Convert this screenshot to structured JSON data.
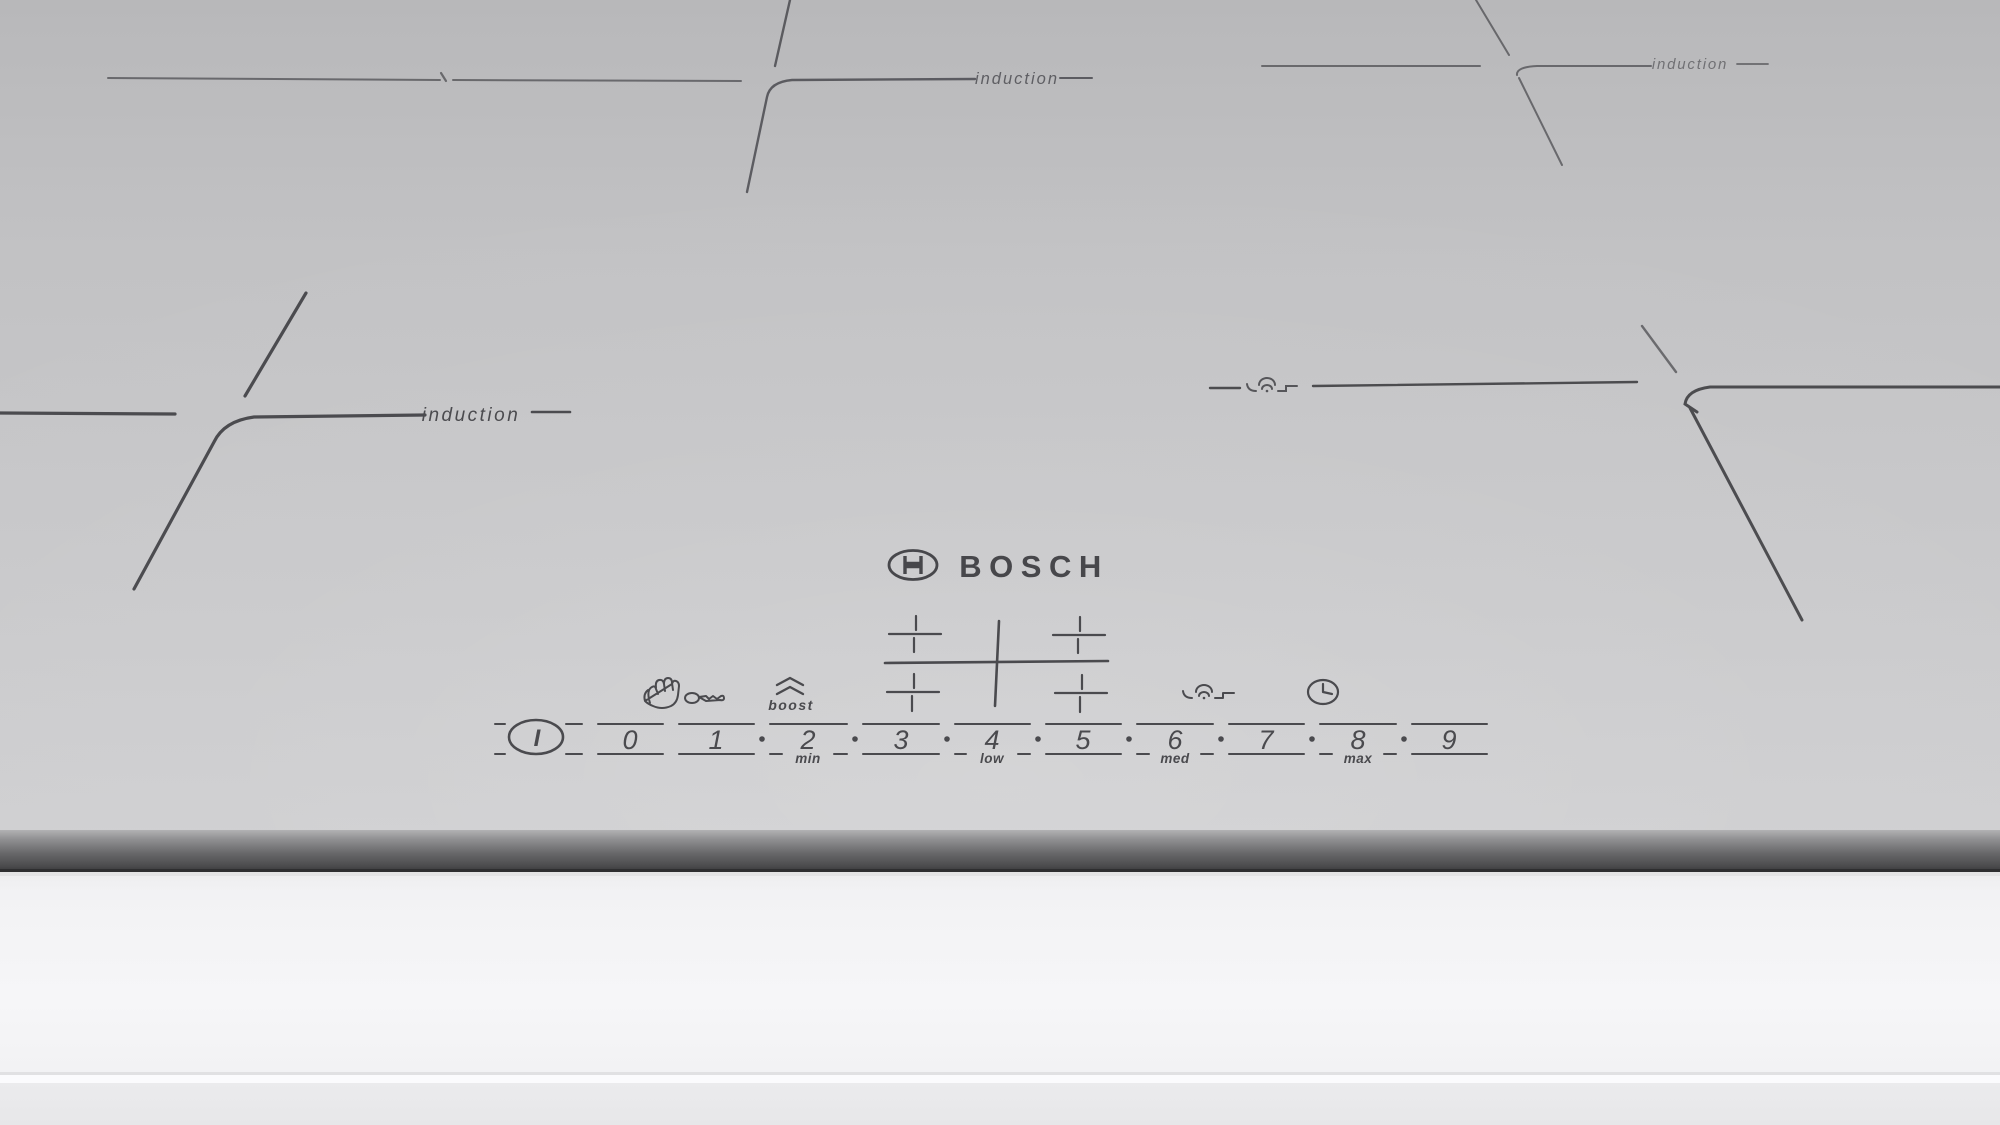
{
  "brand": {
    "name": "BOSCH"
  },
  "zone_labels": {
    "front_left": "induction",
    "back_center": "induction",
    "back_right": "induction"
  },
  "control_panel": {
    "power_symbol": "I",
    "levels": [
      "0",
      "1",
      "2",
      "3",
      "4",
      "5",
      "6",
      "7",
      "8",
      "9"
    ],
    "separator_dot": "·",
    "scale_labels": {
      "min": "min",
      "low": "low",
      "med": "med",
      "max": "max"
    },
    "boost_label": "boost",
    "icons": {
      "child_lock_hand": "hand-icon",
      "child_lock_key": "key-icon",
      "boost_chevrons": "boost-chevrons-icon",
      "pan_sensor": "pan-sensor-icon",
      "timer": "timer-clock-icon",
      "zone_selector": "zone-selector-cross-icon",
      "power": "power-key-icon"
    }
  },
  "colors": {
    "surface": "#c6c6c8",
    "marking_line": "#4a4a4e",
    "front_edge_dark": "#4c4c4e",
    "front_panel": "#f3f3f5"
  }
}
